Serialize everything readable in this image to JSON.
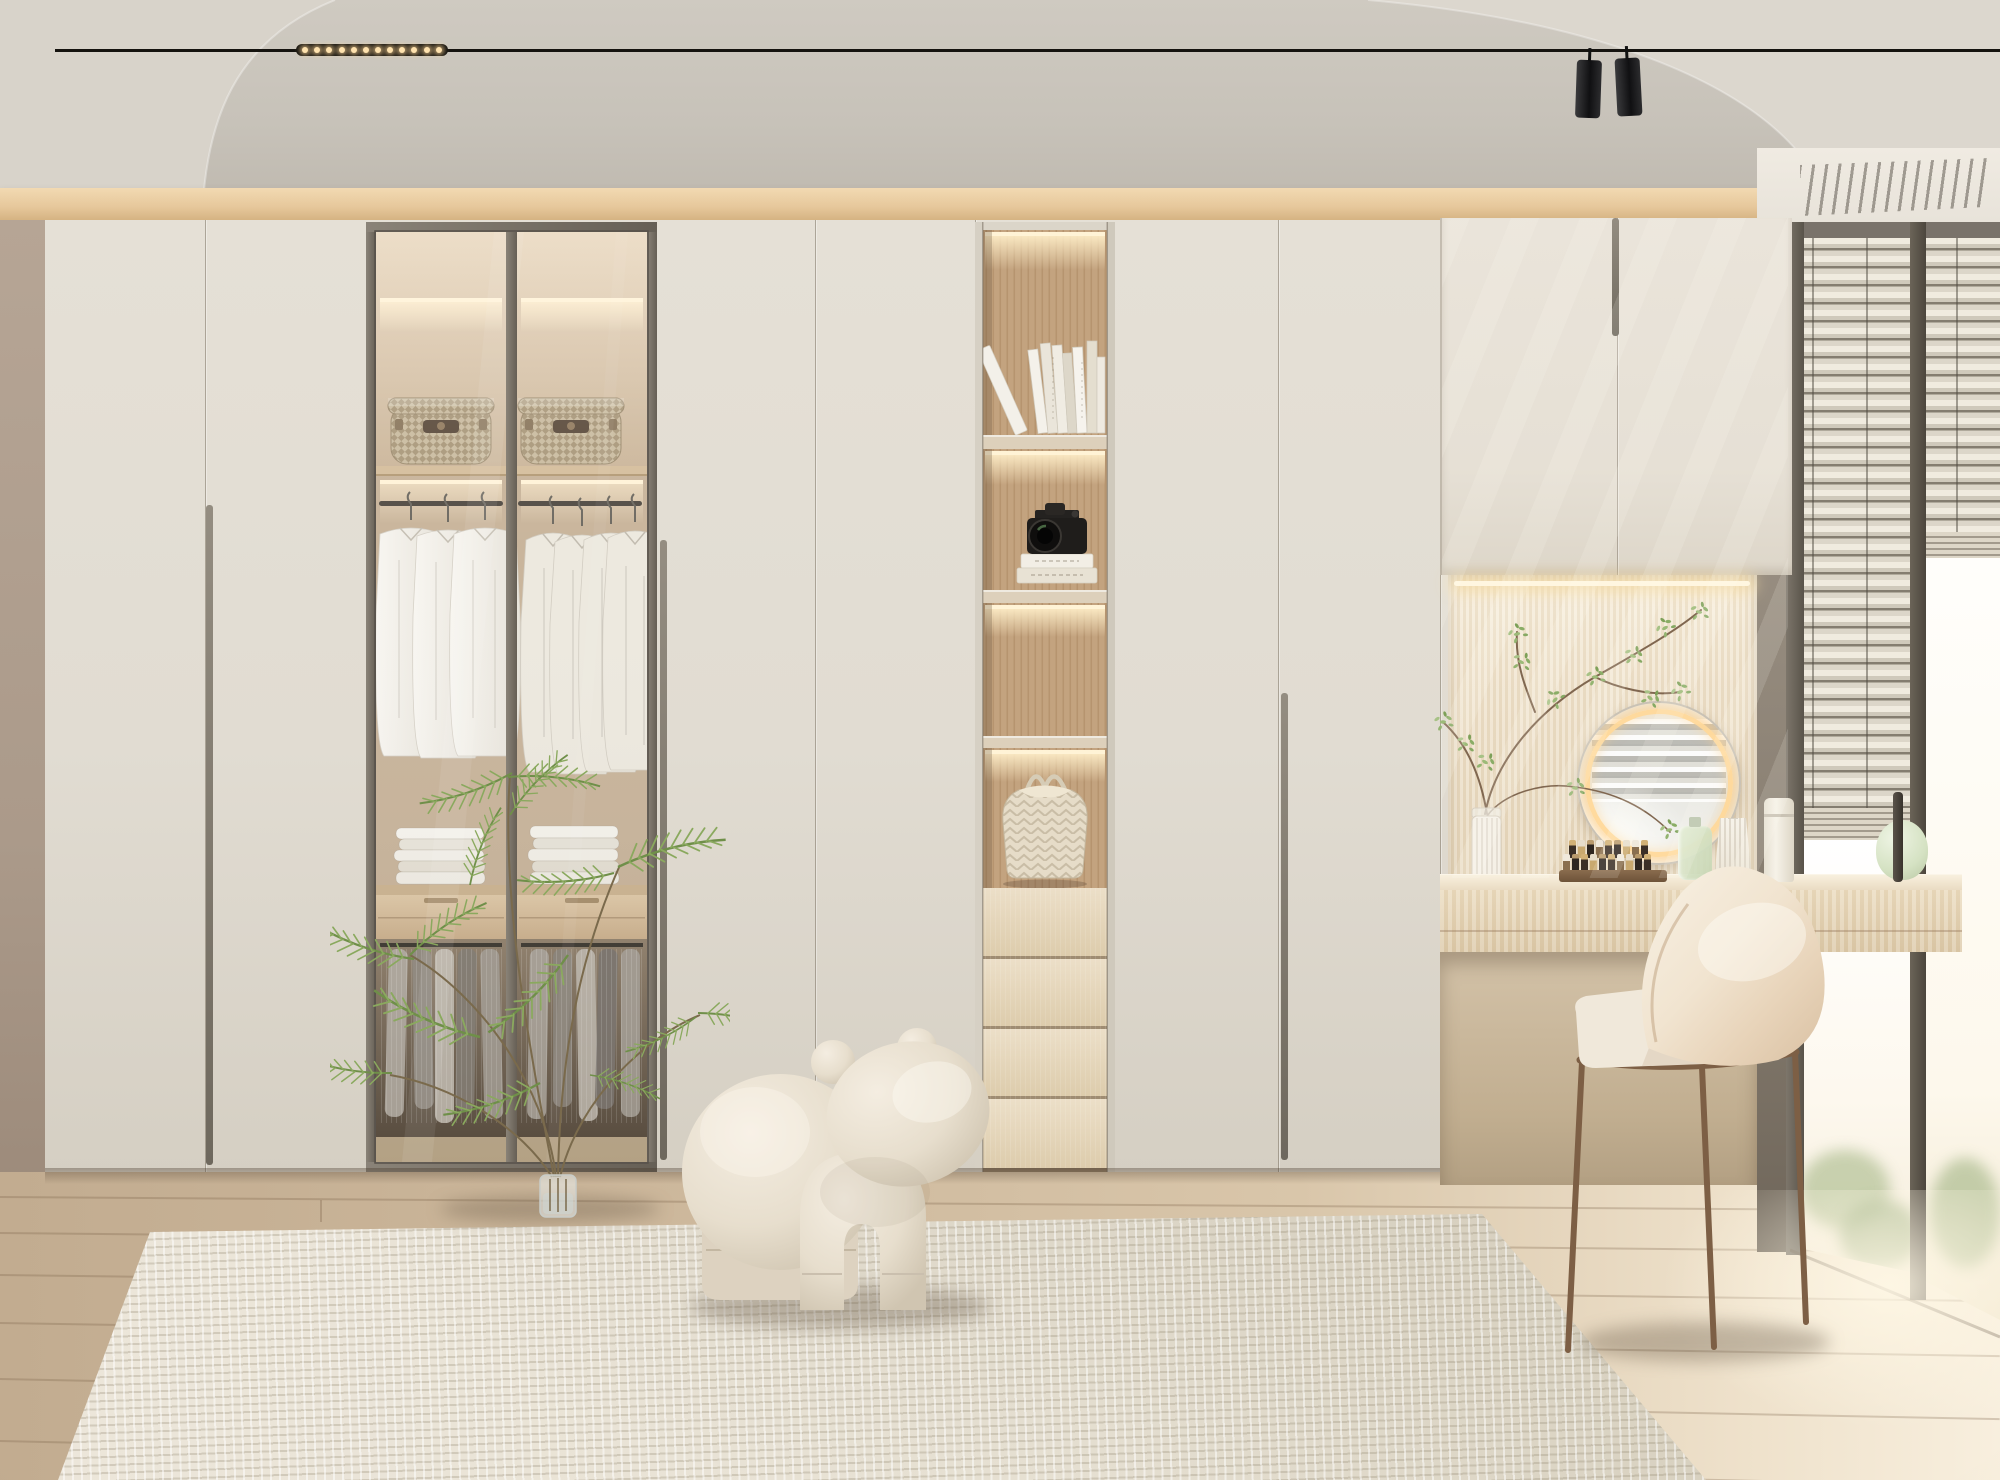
{
  "meta": {
    "description": "Photorealistic interior render of a minimalist cream-toned walk-in wardrobe bedroom with a glass display cabinet, lit open shelving column, vanity nook and corner window",
    "style": "modern minimal, warm neutral palette",
    "lighting": "daylight from right window with warm LED accent strips"
  },
  "palette": {
    "ceiling": "#c7c2b9",
    "left_wall": "#b3a193",
    "oak_trim": "#e9cda2",
    "wardrobe_door": "#e2ddd3",
    "glass_frame": "#7b7469",
    "cabinet_interior": "#c9b59c",
    "niche_wood": "#c2a17f",
    "vanity_wood": "#e8dbc4",
    "floor_oak": "#d2bea2",
    "rug_cream": "#e7e1d4",
    "window_frame": "#6b645a",
    "led_warm": "#ffe9c0",
    "fern_green": "#84a35c",
    "chair_bronze": "#8a6a50",
    "stool_cream": "#e9e0d3",
    "track_black": "#15130f"
  },
  "scene": {
    "ceiling": {
      "label": "ceiling with curved plaster coves"
    },
    "track_light": {
      "label": "recessed black magnetic track light",
      "led_dot_count": 12,
      "spotlight_count": 2
    },
    "oak_trim": {
      "label": "oak trim strip above wardrobe wall"
    },
    "wardrobe": {
      "label": "full-height cream wardrobe wall",
      "plain_door_count": 6,
      "handle": "recessed vertical groove pulls"
    },
    "glass_cabinet": {
      "label": "two-door smoked-glass display wardrobe",
      "top_shelf_items": [
        "woven storage basket",
        "woven storage basket"
      ],
      "hanging_items": "white shirts on hangers",
      "folded_items": "stacks of folded white shirts",
      "lower_items": "hanging grey trousers",
      "lighting": "warm LED strips"
    },
    "display_column": {
      "label": "open display column with lit niches",
      "niche_items": [
        "row of white hardcover books",
        "black DSLR camera on two stacked books",
        "empty lit niche",
        "quilted cream tote bag"
      ],
      "drawer_count": 4
    },
    "vanity": {
      "label": "built-in dressing nook",
      "wall": "light oak slat panel",
      "mirror": "round mirror with warm LED halo",
      "mirror_reflection": "venetian blinds",
      "desk": "floating light-oak dressing desk with drawer",
      "chair": "cream shell chair with bronze steel legs",
      "decor": [
        "branch arrangement in ribbed glass vase",
        "cosmetics organizer tray",
        "green perfume bottle",
        "fluted white perfume bottle",
        "tall white dispenser bottle",
        "green glass gourd vase",
        "slim dark brush bottle"
      ]
    },
    "window": {
      "label": "corner window with venetian blinds",
      "state": "blinds partially raised",
      "view": "bright daylight with faint greenery"
    },
    "soffit_vent": {
      "label": "linear AC diffuser in window soffit"
    },
    "floor": {
      "label": "pale oak plank flooring"
    },
    "rug": {
      "label": "cream waffle-weave wool rug"
    },
    "fern": {
      "label": "asparagus fern sprigs in a glass vase"
    },
    "pony_stool": {
      "label": "cream velvet pony-shaped stool"
    }
  }
}
